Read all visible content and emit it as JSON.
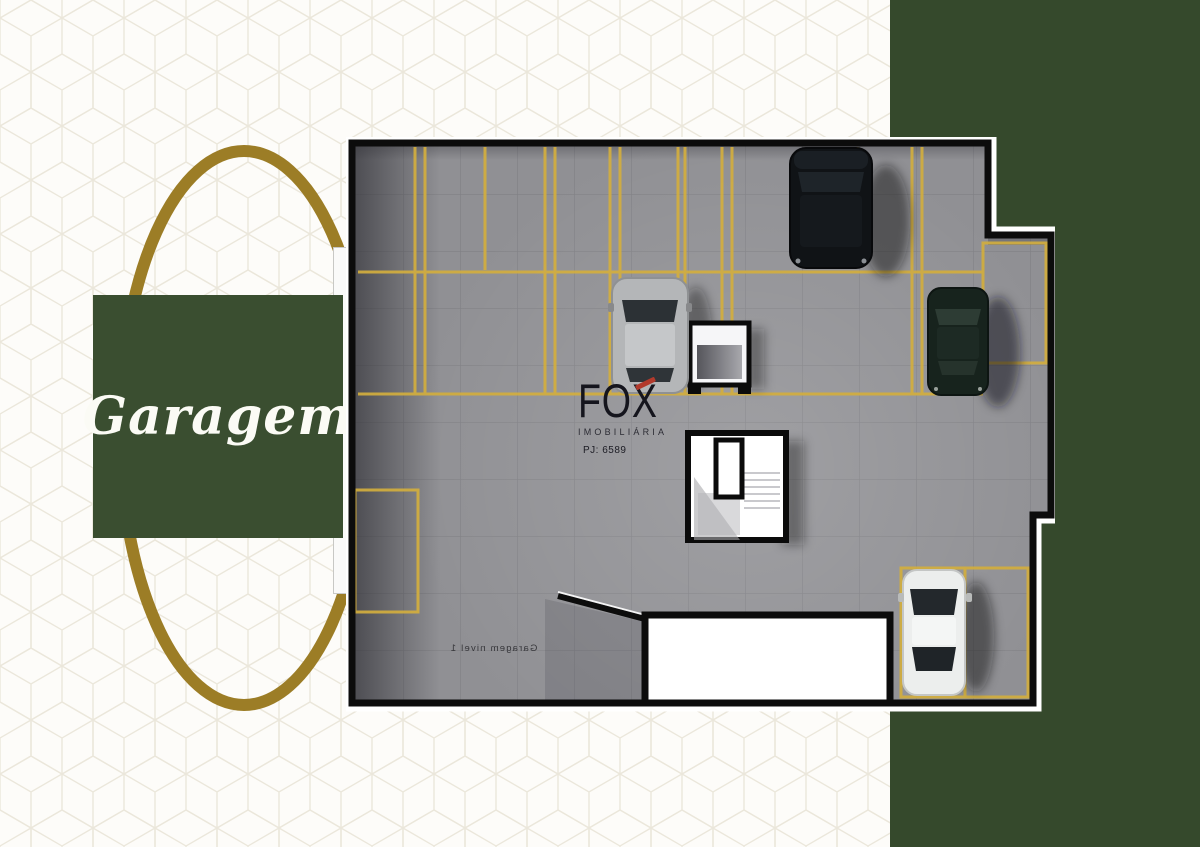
{
  "title_card": {
    "label": "Garagem"
  },
  "watermark": {
    "brand": "FOX",
    "subtitle": "IMOBILIÁRIA",
    "registration": "PJ: 6589"
  },
  "floor_plan": {
    "mirrored_label": "Garagem nivel 1",
    "vehicles": [
      "black-suv",
      "silver-car",
      "dark-green-sedan",
      "white-sedan"
    ],
    "features": [
      "parking-spaces",
      "stairwell",
      "elevator",
      "entrance-ramp"
    ]
  },
  "colors": {
    "label_green": "#3a4e30",
    "panel_green": "#35492c",
    "gold": "#9c7d26",
    "floor_gray": "#909094",
    "marking_yellow": "#d2ae3e",
    "brand_red": "#b23a2c",
    "plan_outline": "#0c0c0c"
  }
}
